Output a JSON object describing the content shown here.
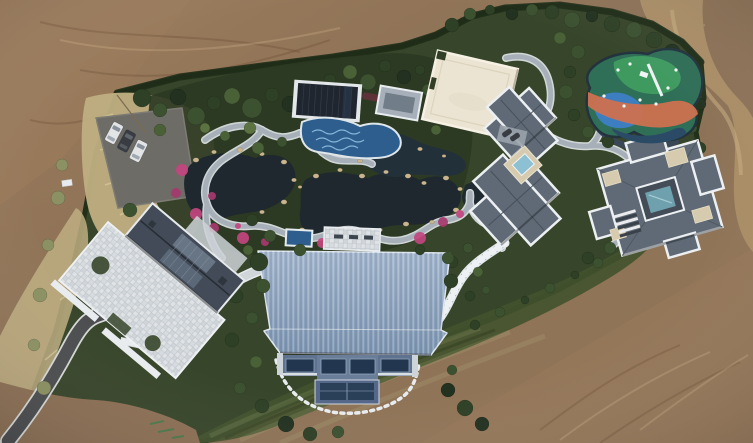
{
  "scene": {
    "title": "Aerial drone photograph of a private landscaped estate",
    "description": "Top-down aerial photograph of a walled estate compound: a Japanese-style water garden with dark ponds, pink azalea beds and winding stone paths; a dark pavilion over a blue mosaic pool; a cream flat court; a colorful children's playground; two gray hip-roofed villas with white trim; a gatehouse with a checkered stone plaza; a parking pad with cars; a large blue ribbed-metal-roof hall; all surrounded by bare brown graded earth and a dirt road",
    "lighting": "overcast daylight",
    "labels": {
      "dirt_terrain": "bare graded earth",
      "dirt_road": "dirt access road",
      "estate_grounds": "hedged estate grounds",
      "dry_grass": "pale dry grass",
      "parking_pad": "gravel parking pad",
      "driveway": "asphalt driveway",
      "gatehouse": "gatehouse with glass ridge",
      "stone_plaza": "checkered stone plaza",
      "pond": "dark garden pond",
      "garden_path": "winding stone path",
      "pavilion": "dark-roofed pool pavilion",
      "mosaic_pool": "blue mosaic pool",
      "court": "cream flat court",
      "playground": "painted playground",
      "villa": "gray hip-roof villa",
      "blue_hall": "blue ribbed-roof hall",
      "lawn": "mowed lawn",
      "stepping_stones": "stepping-stone path"
    },
    "counts": {
      "cars_main_lot": 3,
      "cars_villa_pad": 2,
      "villas": 2,
      "ponds": 2
    },
    "trees": [
      [
        142,
        98,
        9,
        1
      ],
      [
        160,
        110,
        7,
        2
      ],
      [
        178,
        97,
        8,
        0
      ],
      [
        196,
        116,
        9,
        2
      ],
      [
        214,
        103,
        7,
        1
      ],
      [
        232,
        96,
        8,
        3
      ],
      [
        252,
        108,
        10,
        2
      ],
      [
        272,
        95,
        7,
        1
      ],
      [
        290,
        104,
        8,
        0
      ],
      [
        310,
        88,
        7,
        2
      ],
      [
        330,
        80,
        6,
        1
      ],
      [
        350,
        72,
        7,
        3
      ],
      [
        368,
        82,
        8,
        2
      ],
      [
        385,
        66,
        6,
        1
      ],
      [
        404,
        77,
        7,
        0
      ],
      [
        398,
        96,
        6,
        2
      ],
      [
        388,
        112,
        7,
        1
      ],
      [
        378,
        128,
        6,
        3
      ],
      [
        412,
        116,
        5,
        2
      ],
      [
        250,
        128,
        6,
        4
      ],
      [
        225,
        136,
        5,
        3
      ],
      [
        205,
        128,
        5,
        4
      ],
      [
        160,
        130,
        6,
        3
      ],
      [
        452,
        25,
        7,
        1
      ],
      [
        470,
        14,
        6,
        2
      ],
      [
        490,
        10,
        5,
        1
      ],
      [
        512,
        14,
        6,
        0
      ],
      [
        532,
        10,
        6,
        2
      ],
      [
        552,
        12,
        7,
        1
      ],
      [
        572,
        20,
        8,
        2
      ],
      [
        592,
        16,
        6,
        0
      ],
      [
        612,
        24,
        8,
        1
      ],
      [
        634,
        30,
        8,
        2
      ],
      [
        654,
        40,
        8,
        1
      ],
      [
        672,
        52,
        8,
        0
      ],
      [
        688,
        66,
        7,
        2
      ],
      [
        696,
        84,
        7,
        1
      ],
      [
        700,
        104,
        6,
        0
      ],
      [
        560,
        38,
        6,
        3
      ],
      [
        578,
        52,
        7,
        2
      ],
      [
        570,
        72,
        6,
        1
      ],
      [
        566,
        92,
        7,
        2
      ],
      [
        574,
        115,
        6,
        1
      ],
      [
        588,
        132,
        6,
        2
      ],
      [
        608,
        142,
        6,
        1
      ],
      [
        630,
        142,
        5,
        2
      ],
      [
        652,
        136,
        6,
        1
      ],
      [
        672,
        128,
        6,
        0
      ],
      [
        692,
        128,
        5,
        2
      ],
      [
        700,
        148,
        6,
        1
      ],
      [
        706,
        168,
        6,
        2
      ],
      [
        698,
        188,
        6,
        1
      ],
      [
        688,
        206,
        6,
        0
      ],
      [
        668,
        220,
        6,
        2
      ],
      [
        428,
        90,
        6,
        2
      ],
      [
        420,
        70,
        5,
        1
      ],
      [
        436,
        130,
        5,
        3
      ],
      [
        447,
        112,
        5,
        2
      ],
      [
        457,
        96,
        6,
        1
      ],
      [
        600,
        115,
        5,
        2
      ],
      [
        613,
        100,
        5,
        1
      ],
      [
        258,
        148,
        6,
        3
      ],
      [
        282,
        142,
        5,
        2
      ],
      [
        130,
        210,
        7,
        2
      ],
      [
        252,
        220,
        6,
        1
      ],
      [
        270,
        236,
        6,
        2
      ],
      [
        248,
        250,
        5,
        3
      ],
      [
        236,
        296,
        7,
        1
      ],
      [
        252,
        318,
        6,
        2
      ],
      [
        232,
        340,
        7,
        1
      ],
      [
        256,
        362,
        6,
        3
      ],
      [
        240,
        388,
        6,
        2
      ],
      [
        262,
        406,
        7,
        1
      ],
      [
        286,
        424,
        8,
        0
      ],
      [
        310,
        434,
        7,
        1
      ],
      [
        338,
        432,
        6,
        2
      ],
      [
        448,
        390,
        7,
        0
      ],
      [
        465,
        408,
        8,
        1
      ],
      [
        482,
        424,
        7,
        0
      ],
      [
        452,
        370,
        5,
        2
      ],
      [
        452,
        262,
        6,
        1
      ],
      [
        468,
        248,
        5,
        2
      ],
      [
        478,
        272,
        5,
        3
      ],
      [
        470,
        296,
        5,
        1
      ],
      [
        486,
        290,
        4,
        2
      ],
      [
        610,
        248,
        6,
        2
      ],
      [
        588,
        258,
        6,
        1
      ],
      [
        628,
        240,
        5,
        3
      ],
      [
        58,
        198,
        7,
        5
      ],
      [
        48,
        245,
        6,
        5
      ],
      [
        40,
        295,
        7,
        5
      ],
      [
        34,
        345,
        6,
        5
      ],
      [
        44,
        388,
        7,
        5
      ],
      [
        62,
        165,
        6,
        5
      ],
      [
        475,
        325,
        5,
        1
      ],
      [
        500,
        312,
        5,
        2
      ],
      [
        525,
        300,
        4,
        1
      ],
      [
        550,
        288,
        5,
        2
      ],
      [
        575,
        275,
        4,
        1
      ],
      [
        598,
        263,
        5,
        2
      ],
      [
        640,
        238,
        5,
        1
      ],
      [
        259,
        262,
        9,
        1,
        1
      ],
      [
        263,
        286,
        7,
        2,
        1
      ],
      [
        451,
        281,
        7,
        1,
        1
      ],
      [
        448,
        258,
        6,
        2,
        1
      ],
      [
        300,
        250,
        6,
        2,
        1
      ],
      [
        420,
        250,
        5,
        1,
        1
      ]
    ],
    "rocks": [
      [
        196,
        160,
        3
      ],
      [
        214,
        152,
        2.5
      ],
      [
        240,
        150,
        3
      ],
      [
        262,
        154,
        2.5
      ],
      [
        284,
        162,
        3
      ],
      [
        294,
        180,
        2.5
      ],
      [
        284,
        202,
        3
      ],
      [
        262,
        212,
        2.5
      ],
      [
        300,
        187,
        2
      ],
      [
        316,
        176,
        3
      ],
      [
        340,
        170,
        2.5
      ],
      [
        362,
        176,
        3
      ],
      [
        386,
        172,
        2.5
      ],
      [
        408,
        176,
        3
      ],
      [
        424,
        183,
        2.5
      ],
      [
        446,
        178,
        3
      ],
      [
        460,
        189,
        2.5
      ],
      [
        456,
        210,
        3
      ],
      [
        432,
        222,
        2.5
      ],
      [
        406,
        224,
        3
      ],
      [
        380,
        230,
        2.5
      ],
      [
        352,
        232,
        3
      ],
      [
        326,
        238,
        2.5
      ],
      [
        302,
        230,
        3
      ],
      [
        360,
        161,
        2.5
      ],
      [
        390,
        151,
        2
      ],
      [
        420,
        149,
        2.5
      ],
      [
        444,
        156,
        2
      ]
    ],
    "flowers": [
      [
        182,
        170,
        6
      ],
      [
        176,
        193,
        5
      ],
      [
        196,
        214,
        6
      ],
      [
        214,
        228,
        5
      ],
      [
        243,
        238,
        6
      ],
      [
        265,
        242,
        4
      ],
      [
        322,
        243,
        5
      ],
      [
        352,
        240,
        4
      ],
      [
        420,
        238,
        6
      ],
      [
        443,
        222,
        5
      ],
      [
        460,
        214,
        4
      ],
      [
        212,
        196,
        4
      ],
      [
        238,
        226,
        3
      ],
      [
        188,
        252,
        5
      ],
      [
        205,
        260,
        4
      ],
      [
        158,
        246,
        4
      ]
    ],
    "cars": [
      {
        "x": 114,
        "y": 133,
        "rot": 28,
        "dark": false,
        "small": false
      },
      {
        "x": 126.5,
        "y": 141,
        "rot": 28,
        "dark": true,
        "small": false
      },
      {
        "x": 138.5,
        "y": 151,
        "rot": 26,
        "dark": false,
        "small": false
      },
      {
        "x": 507,
        "y": 133,
        "rot": 55,
        "dark": true,
        "small": true
      },
      {
        "x": 515,
        "y": 137,
        "rot": 55,
        "dark": true,
        "small": true
      }
    ]
  },
  "palette": {
    "colors": {
      "dirt1": "#9b7b5c",
      "dirt2": "#8a7055",
      "dirt3": "#95785a",
      "road_tan": "#a98d66",
      "garden": "#37452a",
      "garden_dark": "#2c3a23",
      "hedge": "#223019",
      "lawn": "#43522d",
      "dry_grass": "#beae81",
      "asphalt": "#4c4d4f",
      "path_stone": "#a7b0b8",
      "path_edge": "#e3e8ea",
      "white_stone": "#e9ecee",
      "pond": "#1e282e",
      "pool_blue": "#2e5e8d",
      "pool_wave": "#86b6da",
      "rock": "#c9b691",
      "villa_roof": "#5f6a76",
      "villa_trim": "#edf0f2",
      "villa_ridge": "#454e59",
      "gatehouse_roof": "#424b57",
      "pavilion": "#20262f",
      "court": "#ebe4d2",
      "court_trim": "#f6f1e4",
      "hall_wall": "#5f7390",
      "hall_window": "#22374f",
      "play_base": "#2f6e57",
      "play_green": "#3f9a60",
      "play_blue": "#3d7ec0",
      "play_orange": "#cd7150",
      "play_navy": "#2b4a66",
      "play_border": "#22333e",
      "car_white": "#e2e4e6",
      "car_dark": "#393d43",
      "skylight": "#6fa0ad",
      "cream_pad": "#d6cbaf",
      "villa_pool": "#8cc0d2"
    },
    "tree_shades": [
      "#223120",
      "#2e4026",
      "#3b5130",
      "#4a6137",
      "#5c7241",
      "#8b9162",
      "#1c2b21"
    ],
    "flower_shades": [
      "#c2457f",
      "#a53a6e"
    ]
  }
}
